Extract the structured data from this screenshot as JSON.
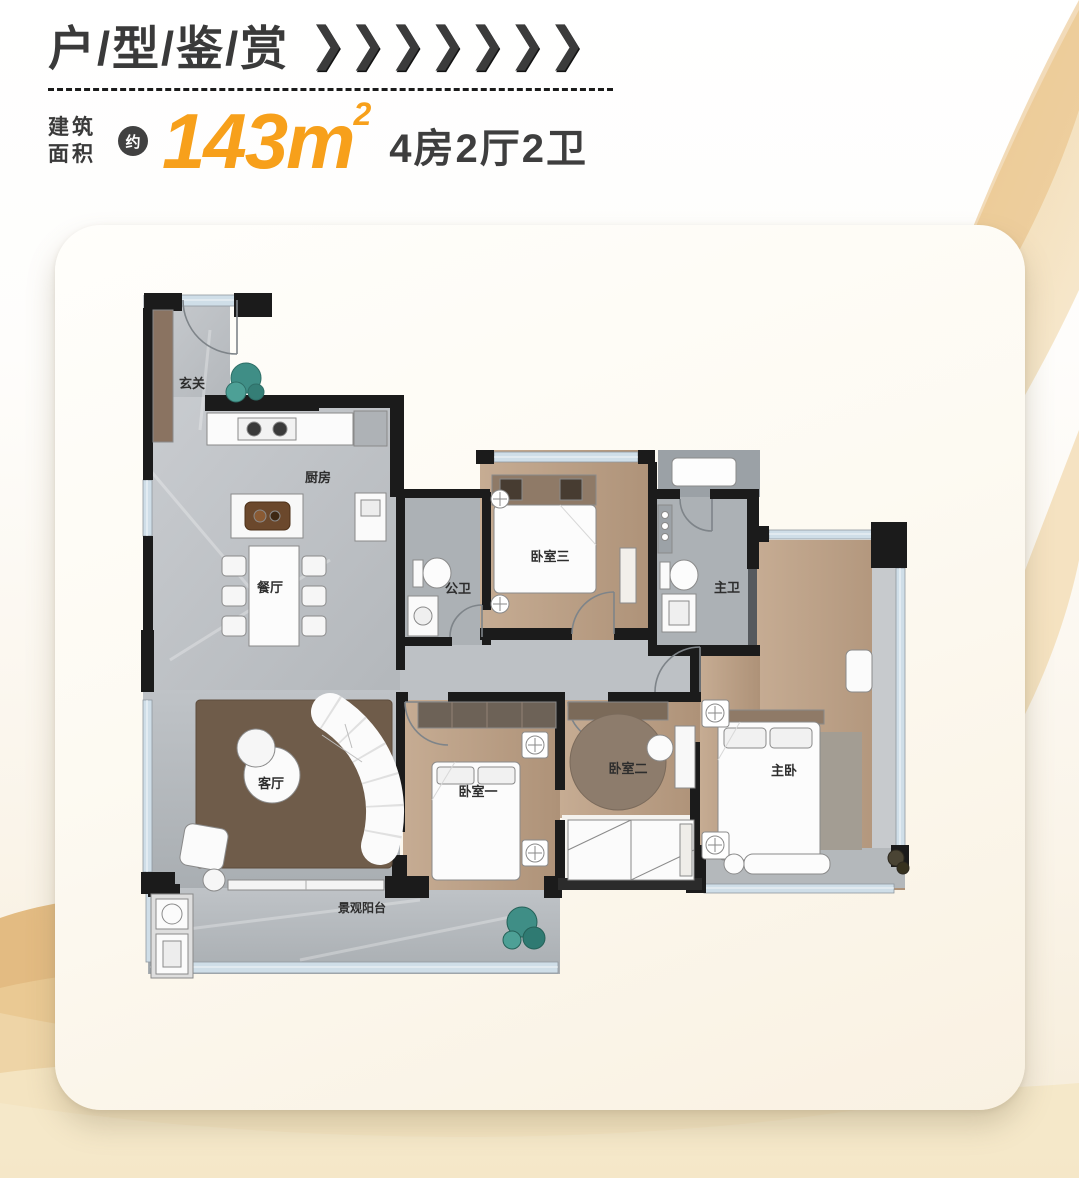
{
  "header": {
    "title": "户/型/鉴/赏",
    "chevrons": "❯❯❯❯❯❯❯",
    "area_label_line1": "建筑",
    "area_label_line2": "面积",
    "approx_badge": "约",
    "area_value": "143m",
    "area_sup": "2",
    "layout_spec": "4房2厅2卫"
  },
  "colors": {
    "accent_orange": "#F7A01B",
    "dark_text": "#3A3A3A",
    "wall_black": "#1B1B1B",
    "marble_floor": "#C2C6CA",
    "bath_floor": "#ABB0B4",
    "wood_floor": "#BCA188",
    "rug_brown": "#6F5C4A",
    "window_blue": "#CFDEE8",
    "gold_wave": "#E7BE7F",
    "card_bg": "#FBF5E9",
    "plant_green": "#3F8E86"
  },
  "floorplan": {
    "rooms": [
      {
        "id": "entrance",
        "label": "玄关"
      },
      {
        "id": "kitchen",
        "label": "厨房"
      },
      {
        "id": "dining",
        "label": "餐厅"
      },
      {
        "id": "public-bath",
        "label": "公卫"
      },
      {
        "id": "bedroom-3",
        "label": "卧室三"
      },
      {
        "id": "master-bath",
        "label": "主卫"
      },
      {
        "id": "living",
        "label": "客厅"
      },
      {
        "id": "bedroom-1",
        "label": "卧室一"
      },
      {
        "id": "bedroom-2",
        "label": "卧室二"
      },
      {
        "id": "master-bedroom",
        "label": "主卧"
      },
      {
        "id": "balcony",
        "label": "景观阳台"
      }
    ]
  }
}
